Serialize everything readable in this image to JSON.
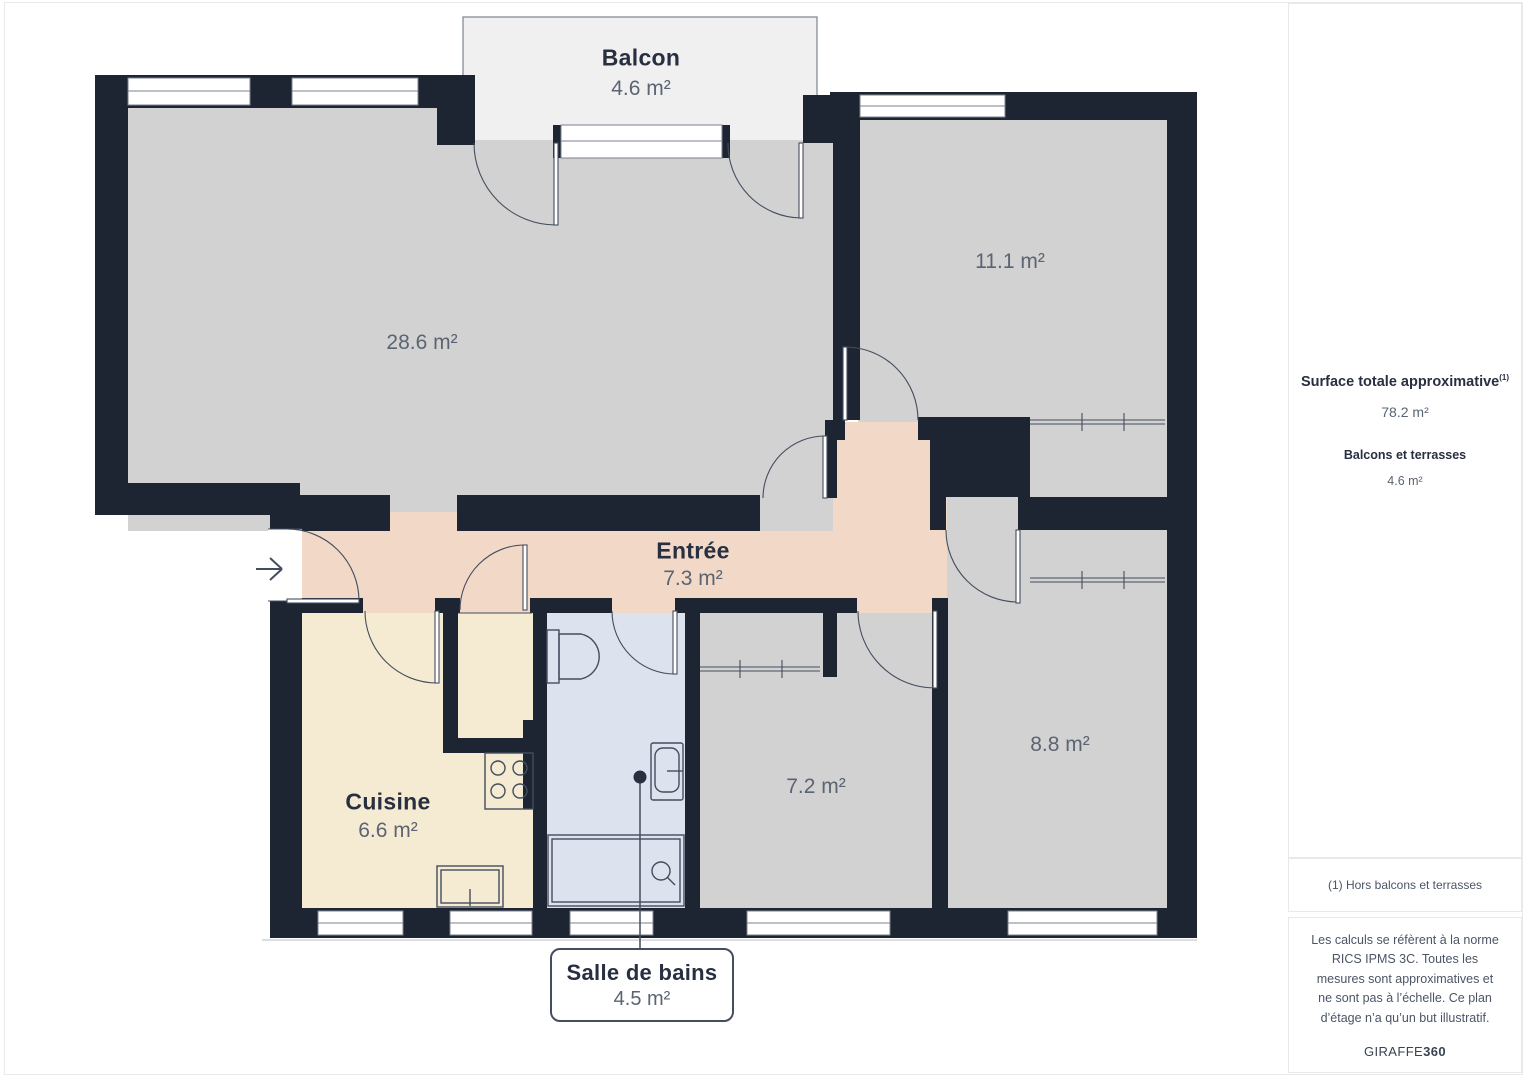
{
  "plan": {
    "rooms": [
      {
        "id": "balcon",
        "name": "Balcon",
        "area": "4.6 m²"
      },
      {
        "id": "sejour",
        "name": "",
        "area": "28.6 m²"
      },
      {
        "id": "chambre-haut",
        "name": "",
        "area": "11.1 m²"
      },
      {
        "id": "entree",
        "name": "Entrée",
        "area": "7.3 m²"
      },
      {
        "id": "cuisine",
        "name": "Cuisine",
        "area": "6.6 m²"
      },
      {
        "id": "salle-de-bains",
        "name": "Salle de bains",
        "area": "4.5 m²"
      },
      {
        "id": "chambre-bas",
        "name": "",
        "area": "7.2 m²"
      },
      {
        "id": "chambre-droite",
        "name": "",
        "area": "8.8 m²"
      }
    ]
  },
  "sidebar": {
    "total_label": "Surface totale approximative",
    "total_footnote_mark": "(1)",
    "total_value": "78.2 m²",
    "balcony_label": "Balcons et terrasses",
    "balcony_value": "4.6 m²",
    "footnote": "(1) Hors balcons et terrasses",
    "disclaimer": "Les calculs se réfèrent à la norme RICS IPMS 3C. Toutes les mesures sont approximatives et ne sont pas à l’échelle. Ce plan d’étage n’a qu’un but illustratif.",
    "brand_name": "GIRAFFE",
    "brand_number": "360"
  },
  "colors": {
    "wall": "#1e2532",
    "room": "#d2d2d2",
    "balcony": "#f0f0f1",
    "entree": "#f2d9c7",
    "kitchen": "#f5ebd3",
    "bath": "#dde3ee",
    "stroke": "#444d5e",
    "frame": "#7b828e",
    "ink": "#272f40",
    "muted": "#5b6473",
    "border": "#e9e9ea"
  }
}
